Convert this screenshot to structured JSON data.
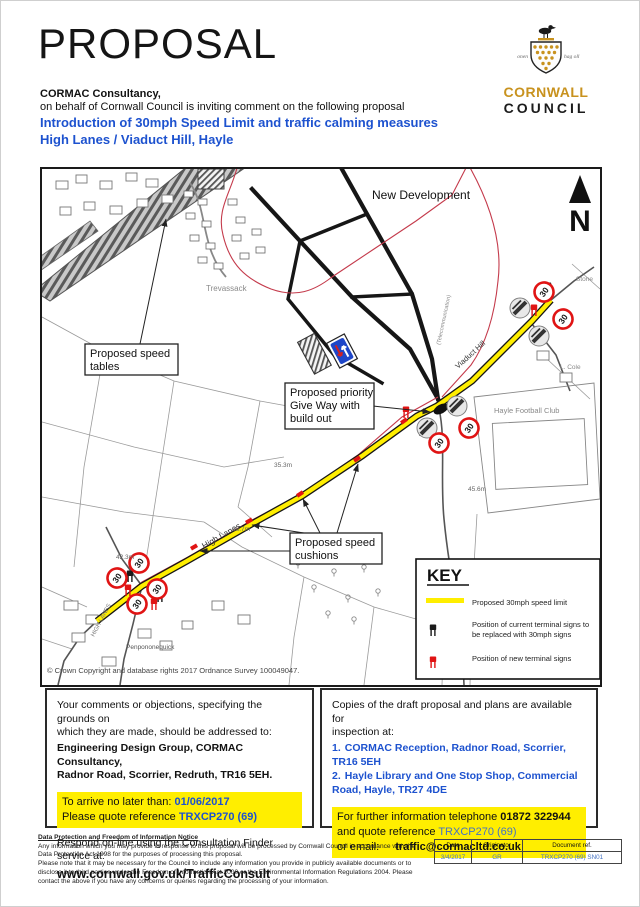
{
  "header": {
    "title": "PROPOSAL",
    "consultancy": "CORMAC Consultancy,",
    "intro": "on behalf of Cornwall Council is inviting comment on the following proposal",
    "proposal_line1": "Introduction of 30mph Speed Limit and traffic calming measures",
    "proposal_line2": "High Lanes / Viaduct Hill, Hayle",
    "logo": {
      "name_line1": "CORNWALL",
      "name_line2": "COUNCIL",
      "motto_left": "onen",
      "motto_right": "hag oll"
    }
  },
  "map": {
    "north_label": "N",
    "labels": {
      "new_development": "New Development",
      "trevassack": "Trevassack",
      "stone": "Stone",
      "l_cole": "L. Cole",
      "telecom": "(Telecommunication)",
      "football_club": "Hayle Football Club",
      "high_lanes_road": "High Lanes",
      "viaduct_hill_road": "Viaduct Hill",
      "high_lanes_small": "HIGH LANES",
      "settlement": "Penpononequick",
      "height_1": "35.3m",
      "height_2": "45.6m",
      "height_3": "38.7m",
      "height_4": "42.3m",
      "sign_30": "30"
    },
    "annotations": {
      "speed_tables": {
        "line1": "Proposed speed",
        "line2": "tables"
      },
      "give_way": {
        "line1": "Proposed priority",
        "line2": "Give Way with",
        "line3": "build out"
      },
      "speed_cushions": {
        "line1": "Proposed speed",
        "line2": "cushions"
      }
    },
    "copyright": "© Crown Copyright and database rights 2017 Ordnance Survey 100049047.",
    "key": {
      "title": "KEY",
      "item1_label": "Proposed 30mph speed limit",
      "item2_line1": "Position of current terminal signs to",
      "item2_line2": "be replaced with 30mph signs",
      "item3_label": "Position of new  terminal signs"
    },
    "colors": {
      "route_yellow": "#ffee00",
      "new_sign_red": "#e01414",
      "boundary_red": "#c43a4b",
      "accent_blue": "#1d52cf",
      "light_blue": "#4472c4",
      "highlight_yellow": "#ffee00"
    }
  },
  "respond_box": {
    "intro_line1": "Your comments or objections, specifying the grounds on",
    "intro_line2": "which they are made, should be addressed to:",
    "address_line1": "Engineering Design Group, CORMAC Consultancy,",
    "address_line2": "Radnor Road, Scorrier, Redruth,  TR16 5EH.",
    "deadline_prefix": "To arrive no later than: ",
    "deadline_value": "01/06/2017",
    "reference_prefix": "Please quote reference ",
    "reference_value": "TRXCP270 (69)",
    "online_line": "Respond on-line using the Consultation Finder service at:",
    "online_url": "www.cornwall.gov.uk/TrafficConsult"
  },
  "copies_box": {
    "intro_line1": "Copies of the draft proposal and plans are available for",
    "intro_line2": "inspection at:",
    "item1_num": "1.",
    "item1_text": "CORMAC Reception, Radnor Road, Scorrier, TR16 5EH",
    "item2_num": "2.",
    "item2_text": "Hayle Library and One Stop Shop, Commercial Road, Hayle, TR27 4DE",
    "info_prefix": "For further information telephone ",
    "phone": "01872 322944",
    "quote_prefix": "and quote reference ",
    "reference_value": "TRXCP270 (69)",
    "email_prefix": "or email:",
    "email": "traffic@cormacltd.co.uk"
  },
  "footer": {
    "notice_title": "Data Protection and Freedom of Information Notice",
    "notice_p1": "Any information which you may provide in response to this proposal will be processed by Cornwall Council in accordance with the Data Protection Act 1998 for the purposes of processing this proposal.",
    "notice_p2": "Please note that it may be necessary for the Council to include any information you provide in publicly available documents or to disclose it to third parties under the Freedom of Information Act 2000 or the Environmental Information Regulations 2004. Please contact the above if you have any concerns or queries regarding the processing of your information.",
    "table": {
      "col1": "Date",
      "col2": "Originator",
      "col3": "Document ref.",
      "val1": "3/4/2017",
      "val2": "GR",
      "val3": "TRXCP270 (69) SN01"
    }
  }
}
